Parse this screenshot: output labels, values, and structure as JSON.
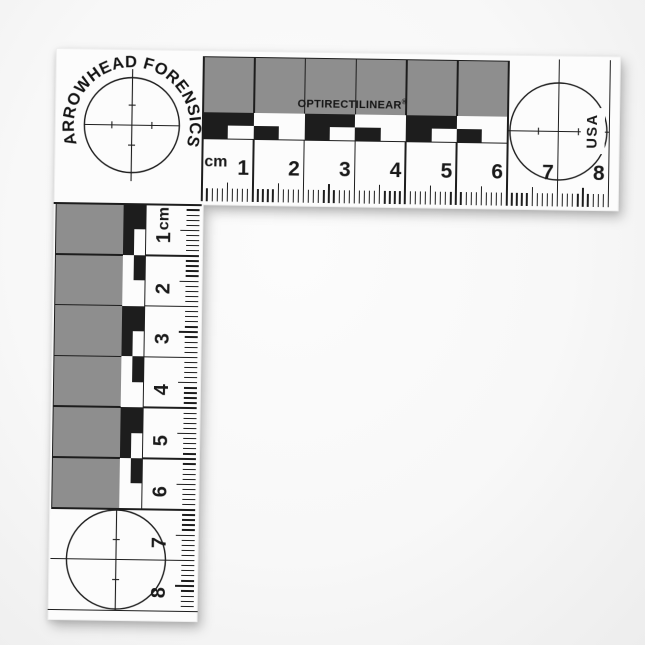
{
  "colors": {
    "background": "#f6f6f6",
    "ruler_white": "#fcfcfc",
    "print_black": "#1d1d1d",
    "gray_block": "#8e8e8e"
  },
  "scale": {
    "brand_arc": "ARROWHEAD FORENSICS",
    "product_name": "OPTIRECTILINEAR",
    "registered_mark": "®",
    "country": "USA",
    "unit_h": "cm",
    "unit_v": "cm",
    "numbers_h": [
      "1",
      "2",
      "3",
      "4",
      "5",
      "6",
      "7",
      "8"
    ],
    "numbers_v": [
      "1",
      "2",
      "3",
      "4",
      "5",
      "6",
      "7",
      "8"
    ],
    "cm_total": 8,
    "gray_cm": 6,
    "cm_px": 50.8,
    "mm_px": 5.08
  }
}
